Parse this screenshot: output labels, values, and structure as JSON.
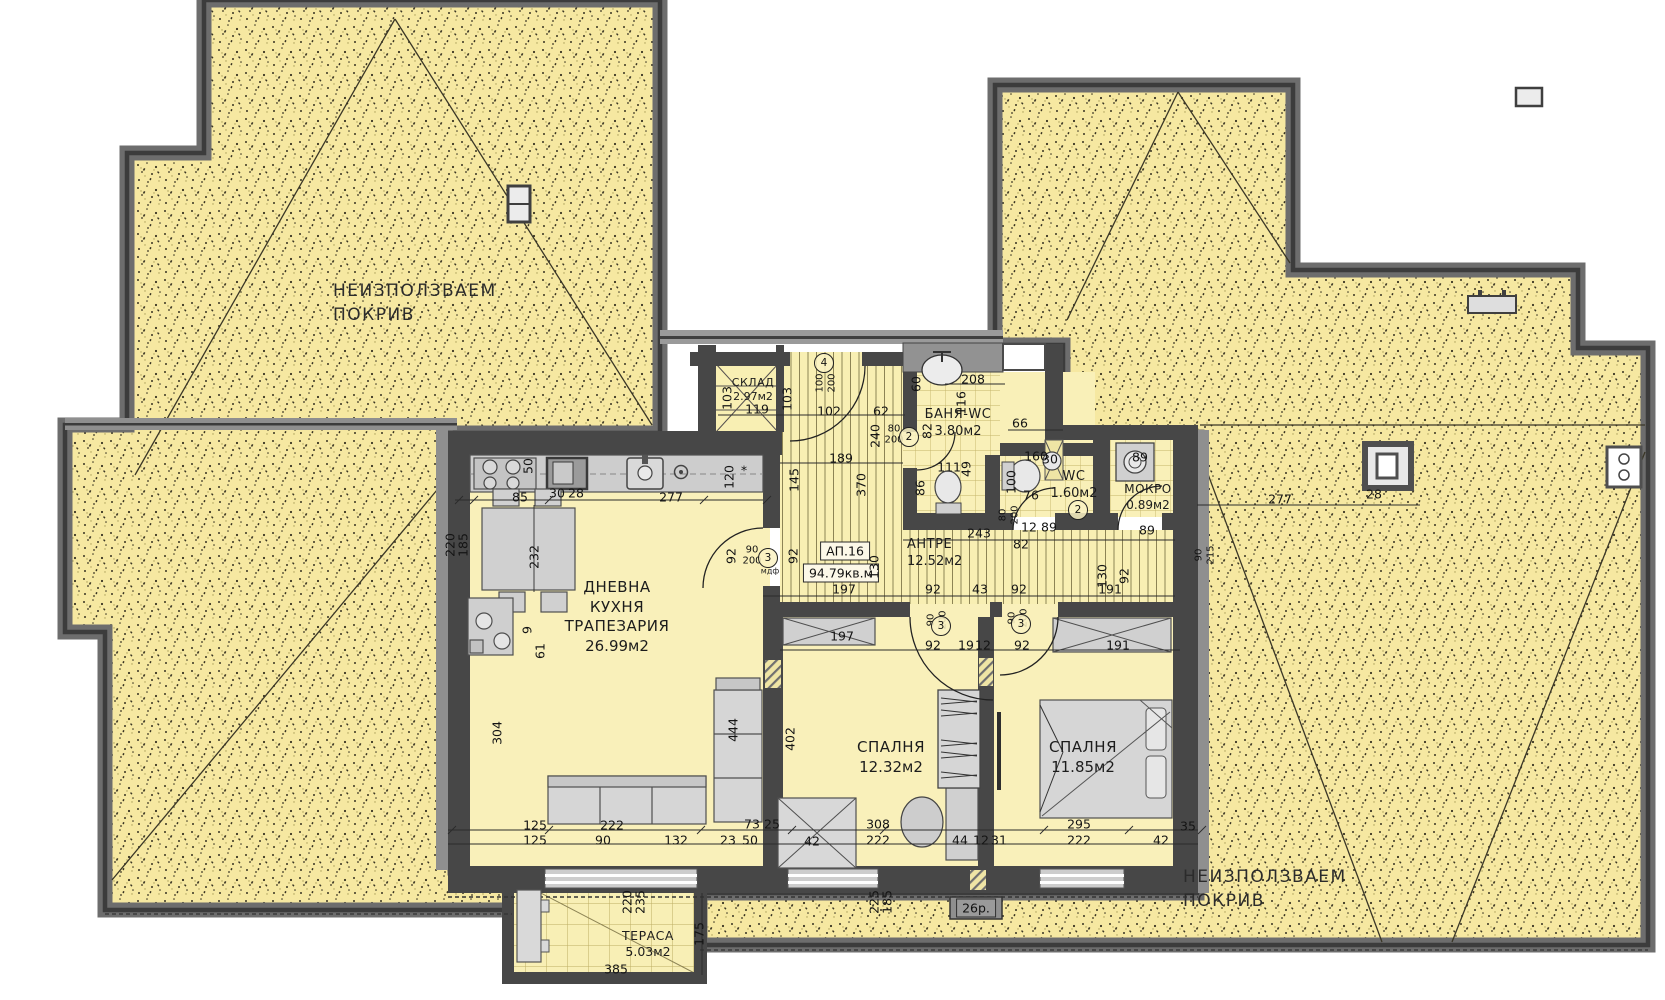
{
  "palette": {
    "roof_fill": "#f6e8a1",
    "floor_fill": "#f9f0ba",
    "wall_dark": "#474747",
    "wall_light": "#8f8f8f",
    "furniture": "#d4d4d4",
    "tile_line": "#c4b469"
  },
  "apartment": {
    "id": "АП.16",
    "total_area": "94.79кв.м"
  },
  "roof_areas": [
    {
      "label_lines": [
        "НЕИЗПОЛЗВАЕМ",
        "ПОКРИВ"
      ],
      "x": 333,
      "y": 280
    },
    {
      "label_lines": [
        "НЕИЗПОЛЗВАЕМ",
        "ПОКРИВ"
      ],
      "x": 1183,
      "y": 866
    }
  ],
  "rooms": [
    {
      "name_lines": [
        "ДНЕВНА",
        "КУХНЯ",
        "ТРАПЕЗАРИЯ"
      ],
      "area": "26.99м2",
      "x": 617,
      "y": 578,
      "fs": 15
    },
    {
      "name_lines": [
        "СПАЛНЯ"
      ],
      "area": "12.32м2",
      "x": 891,
      "y": 738,
      "fs": 15
    },
    {
      "name_lines": [
        "СПАЛНЯ"
      ],
      "area": "11.85м2",
      "x": 1083,
      "y": 738,
      "fs": 15
    },
    {
      "name_lines": [
        "АНТРЕ"
      ],
      "area": "12.52м2",
      "x": 907,
      "y": 537,
      "fs": 13,
      "align": "left"
    },
    {
      "name_lines": [
        "БАНЯ-WC"
      ],
      "area": "3.80м2",
      "x": 958,
      "y": 407,
      "fs": 13
    },
    {
      "name_lines": [
        "WC"
      ],
      "area": "1.60м2",
      "x": 1074,
      "y": 469,
      "fs": 13
    },
    {
      "name_lines": [
        "МОКРО"
      ],
      "area": "0.89м2",
      "x": 1148,
      "y": 482,
      "fs": 12
    },
    {
      "name_lines": [
        "СКЛАД"
      ],
      "area": "2.97м2",
      "x": 753,
      "y": 376,
      "fs": 11
    },
    {
      "name_lines": [
        "ТЕРАСА"
      ],
      "area": "5.03м2",
      "x": 648,
      "y": 928,
      "fs": 12.5
    }
  ],
  "boxed_labels": [
    {
      "t": "26р.",
      "x": 976,
      "y": 908,
      "style": "dark"
    }
  ],
  "circled_marks": [
    {
      "t": "4",
      "x": 824,
      "y": 363
    },
    {
      "t": "2",
      "x": 909,
      "y": 437
    },
    {
      "t": "3",
      "x": 768,
      "y": 558
    },
    {
      "t": "3",
      "x": 941,
      "y": 626
    },
    {
      "t": "3",
      "x": 1021,
      "y": 624
    },
    {
      "t": "2",
      "x": 1078,
      "y": 510
    }
  ],
  "tiny_labels": [
    {
      "t": "мдф",
      "x": 770,
      "y": 571
    }
  ],
  "dims": [
    [
      "85",
      520,
      497
    ],
    [
      "30",
      557,
      493
    ],
    [
      "28",
      576,
      493
    ],
    [
      "277",
      671,
      497
    ],
    [
      "120",
      729,
      477,
      "v"
    ],
    [
      "50",
      528,
      466,
      "v"
    ],
    [
      "232",
      534,
      557,
      "v"
    ],
    [
      "220",
      450,
      545,
      "v"
    ],
    [
      "185",
      463,
      545,
      "v"
    ],
    [
      "92",
      731,
      556,
      "v"
    ],
    [
      "90",
      752,
      550,
      "s"
    ],
    [
      "200",
      752,
      561,
      "s"
    ],
    [
      "9",
      527,
      630,
      "v"
    ],
    [
      "61",
      540,
      651,
      "v"
    ],
    [
      "304",
      497,
      733,
      "v"
    ],
    [
      "444",
      733,
      730,
      "v"
    ],
    [
      "402",
      790,
      739,
      "v"
    ],
    [
      "103",
      727,
      398,
      "v"
    ],
    [
      "103",
      787,
      399,
      "v"
    ],
    [
      "119",
      757,
      409
    ],
    [
      "102",
      829,
      411
    ],
    [
      "62",
      881,
      411
    ],
    [
      "100",
      820,
      383,
      "vs"
    ],
    [
      "200",
      832,
      383,
      "vs"
    ],
    [
      "189",
      841,
      458
    ],
    [
      "145",
      794,
      480,
      "v"
    ],
    [
      "370",
      861,
      485,
      "v"
    ],
    [
      "240",
      875,
      436,
      "v"
    ],
    [
      "80",
      894,
      429,
      "s"
    ],
    [
      "200",
      894,
      440,
      "s"
    ],
    [
      "82",
      927,
      431,
      "v"
    ],
    [
      "60",
      916,
      384,
      "v"
    ],
    [
      "208",
      973,
      379
    ],
    [
      "116",
      961,
      403,
      "v"
    ],
    [
      "111",
      949,
      467
    ],
    [
      "49",
      966,
      469,
      "v"
    ],
    [
      "86",
      920,
      488,
      "v"
    ],
    [
      "66",
      1020,
      423
    ],
    [
      "30",
      1050,
      459
    ],
    [
      "160",
      1036,
      456
    ],
    [
      "100",
      1011,
      482,
      "v"
    ],
    [
      "76",
      1031,
      495
    ],
    [
      "89",
      1140,
      457
    ],
    [
      "243",
      979,
      533
    ],
    [
      "82",
      1021,
      544
    ],
    [
      "12",
      1029,
      527
    ],
    [
      "89",
      1049,
      527
    ],
    [
      "89",
      1147,
      530
    ],
    [
      "80",
      1003,
      515,
      "vs"
    ],
    [
      "200",
      1015,
      515,
      "vs"
    ],
    [
      "92",
      793,
      556,
      "v"
    ],
    [
      "130",
      874,
      567,
      "v"
    ],
    [
      "92",
      1124,
      576,
      "v"
    ],
    [
      "130",
      1102,
      576,
      "v"
    ],
    [
      "90",
      1199,
      555,
      "vs"
    ],
    [
      "215",
      1211,
      555,
      "vs"
    ],
    [
      "197",
      844,
      589
    ],
    [
      "92",
      933,
      589
    ],
    [
      "43",
      980,
      589
    ],
    [
      "92",
      1019,
      589
    ],
    [
      "191",
      1110,
      589
    ],
    [
      "92",
      933,
      645
    ],
    [
      "19",
      966,
      645
    ],
    [
      "12",
      983,
      645
    ],
    [
      "92",
      1022,
      645
    ],
    [
      "191",
      1118,
      645
    ],
    [
      "90",
      931,
      620,
      "vs"
    ],
    [
      "200",
      943,
      620,
      "vs"
    ],
    [
      "90",
      1012,
      618,
      "vs"
    ],
    [
      "200",
      1024,
      618,
      "vs"
    ],
    [
      "197",
      842,
      636
    ],
    [
      "277",
      1280,
      499
    ],
    [
      "28",
      1374,
      494
    ],
    [
      "125",
      535,
      825
    ],
    [
      "222",
      612,
      825
    ],
    [
      "73",
      752,
      824
    ],
    [
      "25",
      772,
      824
    ],
    [
      "308",
      878,
      824
    ],
    [
      "295",
      1079,
      824
    ],
    [
      "35",
      1188,
      826
    ],
    [
      "125",
      535,
      840
    ],
    [
      "90",
      603,
      840
    ],
    [
      "132",
      676,
      840
    ],
    [
      "23",
      728,
      840
    ],
    [
      "50",
      750,
      840
    ],
    [
      "42",
      812,
      841
    ],
    [
      "222",
      878,
      840
    ],
    [
      "44",
      960,
      840
    ],
    [
      "12",
      981,
      840
    ],
    [
      "31",
      999,
      840
    ],
    [
      "222",
      1079,
      840
    ],
    [
      "42",
      1161,
      840
    ],
    [
      "225",
      874,
      902,
      "v"
    ],
    [
      "185",
      887,
      902,
      "v"
    ],
    [
      "220",
      627,
      902,
      "v"
    ],
    [
      "235",
      640,
      902,
      "v"
    ],
    [
      "175",
      699,
      934,
      "v"
    ],
    [
      "385",
      616,
      969
    ],
    [
      "*",
      744,
      470
    ]
  ]
}
